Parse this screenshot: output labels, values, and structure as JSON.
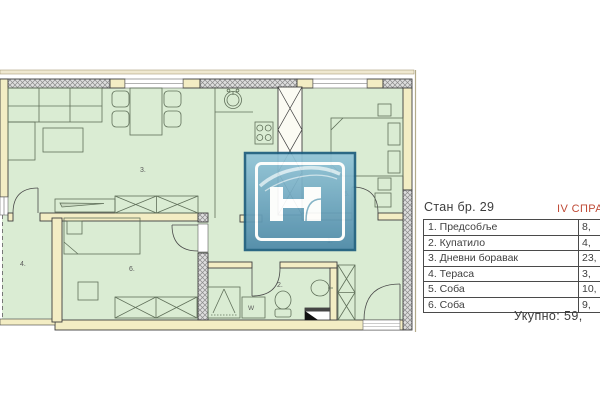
{
  "info_panel": {
    "title": "Стан бр. 29",
    "floor_label": "IV СПРАТ",
    "rooms": [
      {
        "name": "1. Предсобље",
        "area": "8,"
      },
      {
        "name": "2. Купатило",
        "area": "4,"
      },
      {
        "name": "3. Дневни боравак",
        "area": "23,"
      },
      {
        "name": "4. Тераса",
        "area": "3,"
      },
      {
        "name": "5. Соба",
        "area": "10,"
      },
      {
        "name": "6. Соба",
        "area": "9,"
      }
    ],
    "total_label": "Укупно: 59,"
  },
  "plan": {
    "room_numbers": {
      "living": "3.",
      "terrace": "4.",
      "bedroom_small": "6.",
      "bathroom": "2.",
      "bedroom_main": "5.",
      "hallway": "1."
    },
    "washer_label": "W",
    "colors": {
      "room_fill": "#daecd3",
      "wall_fill": "#f3edc4",
      "wall_outline": "#3d3d3d",
      "furniture_line": "#60705a",
      "accent_red": "#bf4a36",
      "logo_blue": "#4d89a8",
      "logo_border": "#1e5f7f"
    }
  }
}
